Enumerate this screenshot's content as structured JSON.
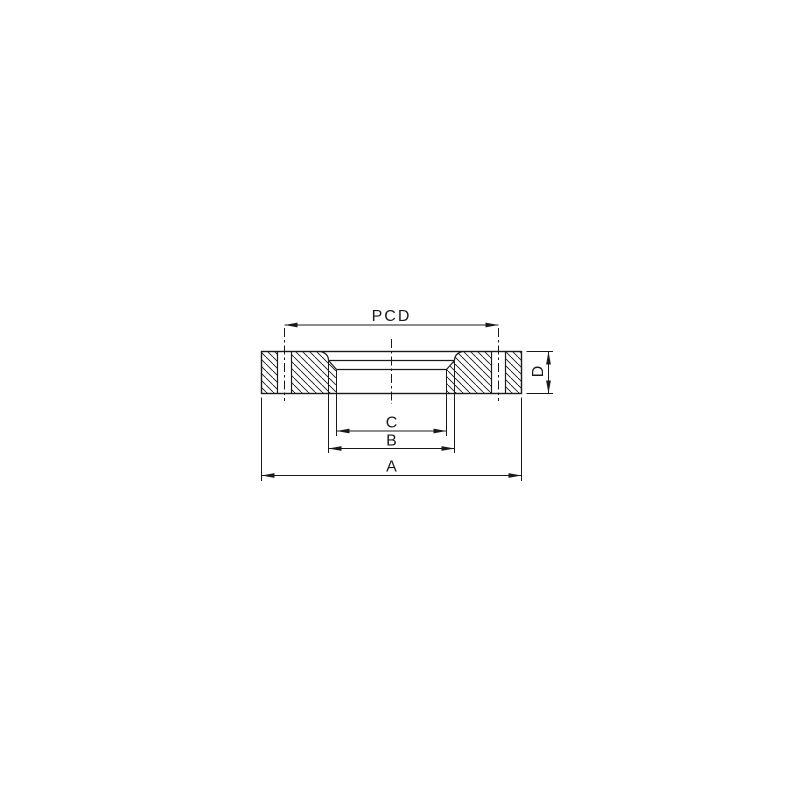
{
  "page": {
    "background": "#ffffff"
  },
  "drawing": {
    "kind": "flange-cross-section-engineering-drawing",
    "line_color": "#1a1a1a",
    "background": "#ffffff",
    "labels": {
      "bolt_circle_diameter": "PCD",
      "outer_diameter": "A",
      "counterbore_diameter": "B",
      "bore_diameter": "C",
      "thickness": "D"
    }
  }
}
